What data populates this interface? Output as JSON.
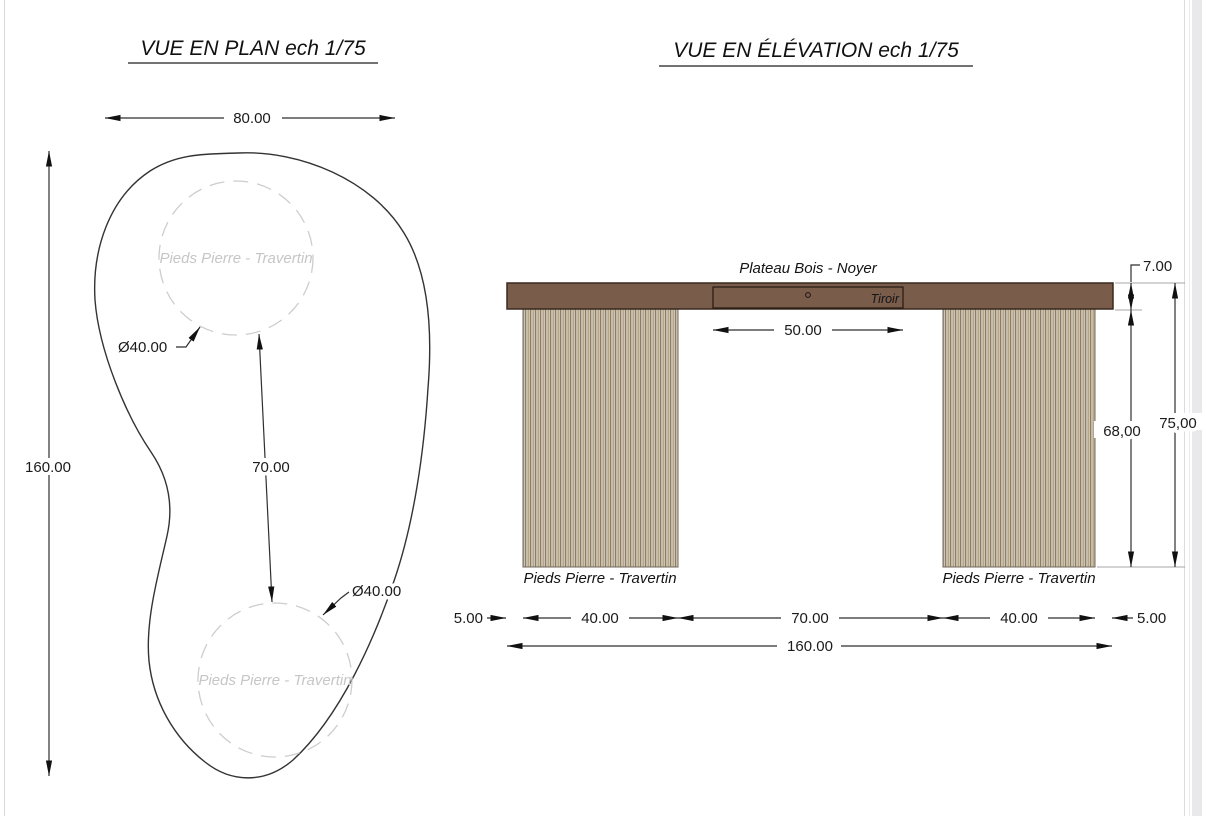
{
  "plan_view": {
    "title": "VUE EN PLAN ech 1/75",
    "width_dim": "80.00",
    "height_dim": "160.00",
    "gap_dim": "70.00",
    "diameter_top": "Ø40.00",
    "diameter_bottom": "Ø40.00",
    "top_circle_label": "Pieds Pierre - Travertin",
    "bottom_circle_label": "Pieds Pierre - Travertin"
  },
  "elevation_view": {
    "title": "VUE EN ÉLÉVATION ech 1/75",
    "plateau_label": "Plateau Bois - Noyer",
    "drawer_label": "Tiroir",
    "drawer_width_dim": "50.00",
    "top_thickness_dim": "7.00",
    "leg_height_dim": "68,00",
    "total_height_dim": "75,00",
    "left_leg_label": "Pieds Pierre - Travertin",
    "right_leg_label": "Pieds Pierre - Travertin",
    "left_overhang_dim": "5.00",
    "left_leg_width_dim": "40.00",
    "span_dim": "70.00",
    "right_leg_width_dim": "40.00",
    "right_overhang_dim": "5.00",
    "total_width_dim": "160.00"
  },
  "colors": {
    "plateau_fill": "#7a5c4a",
    "plateau_outline": "#39291f",
    "leg_stripe_light": "#d6ccba",
    "leg_stripe_mid": "#b3a689",
    "leg_stripe_dark": "#8a7e6a",
    "dashed_circle": "#cdcdcd",
    "gray_label": "#c6c6c6",
    "linework": "#2f2f2f",
    "page_edge": "#d9d9d9",
    "scrollbar": "#e9e9ec"
  }
}
